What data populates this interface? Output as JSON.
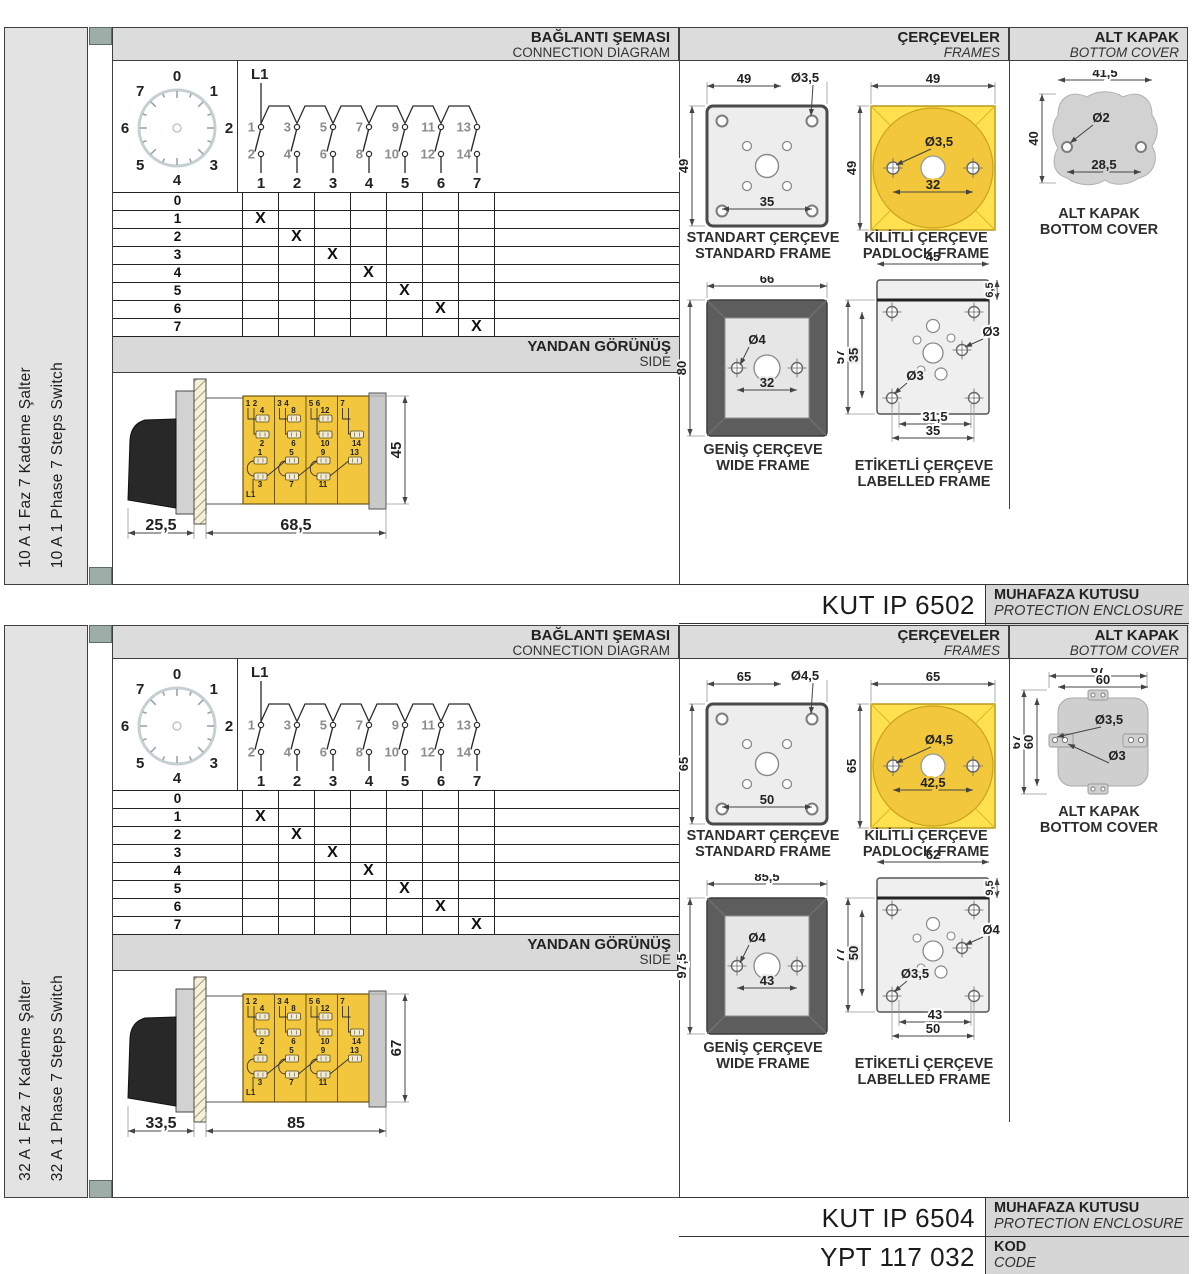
{
  "sections": [
    {
      "sidebar": {
        "tr": "10 A 1 Faz 7 Kademe Şalter",
        "en": "10 A 1 Phase 7 Steps Switch"
      },
      "header": {
        "diagram_tr": "BAĞLANTI ŞEMASI",
        "diagram_en": "CONNECTION DIAGRAM",
        "frames_tr": "ÇERÇEVELER",
        "frames_en": "FRAMES",
        "cover_tr": "ALT KAPAK",
        "cover_en": "BOTTOM COVER"
      },
      "side_band": {
        "tr": "YANDAN GÖRÜNÜŞ",
        "en": "SIDE"
      },
      "dial": {
        "positions": [
          "0",
          "1",
          "2",
          "3",
          "4",
          "5",
          "6",
          "7"
        ]
      },
      "circuit": {
        "feed": "L1",
        "top_contacts": [
          "1",
          "3",
          "5",
          "7",
          "9",
          "11",
          "13"
        ],
        "bottom_contacts": [
          "2",
          "4",
          "6",
          "8",
          "10",
          "12",
          "14"
        ],
        "switch_numbers": [
          "1",
          "2",
          "3",
          "4",
          "5",
          "6",
          "7"
        ]
      },
      "step_table": {
        "row_labels": [
          "0",
          "1",
          "2",
          "3",
          "4",
          "5",
          "6",
          "7"
        ],
        "mark": "X",
        "marks": [
          [
            1,
            1
          ],
          [
            2,
            2
          ],
          [
            3,
            3
          ],
          [
            4,
            4
          ],
          [
            5,
            5
          ],
          [
            6,
            6
          ],
          [
            7,
            7
          ]
        ]
      },
      "side_view": {
        "front_depth": "25,5",
        "body_length": "68,5",
        "height": "45",
        "feed": "L1",
        "top_pairs": [
          [
            "1",
            "2"
          ],
          [
            "3",
            "4"
          ],
          [
            "5",
            "6"
          ],
          [
            "7"
          ]
        ],
        "upper_mid": [
          "4",
          "8",
          "12",
          ""
        ],
        "lower_mid": [
          "2",
          "6",
          "10",
          "14"
        ],
        "bottom_upper": [
          "1",
          "5",
          "9",
          "13"
        ],
        "bottom_lower": [
          "3",
          "7",
          "11",
          ""
        ]
      },
      "frames": {
        "standard": {
          "caption_tr": "STANDART ÇERÇEVE",
          "caption_en": "STANDARD FRAME",
          "width": "49",
          "height": "49",
          "hole": "Ø3,5",
          "pitch": "35"
        },
        "padlock": {
          "caption_tr": "KİLİTLİ ÇERÇEVE",
          "caption_en": "PADLOCK FRAME",
          "width": "49",
          "height": "49",
          "hole": "Ø3,5",
          "pitch": "32"
        },
        "wide": {
          "caption_tr": "GENİŞ ÇERÇEVE",
          "caption_en": "WIDE FRAME",
          "width": "66",
          "height": "80",
          "hole": "Ø4",
          "pitch": "32"
        },
        "labelled": {
          "caption_tr": "ETİKETLİ ÇERÇEVE",
          "caption_en": "LABELLED FRAME",
          "width": "45",
          "band": "6,5",
          "height_outer": "57",
          "height_inner": "35",
          "hole_right": "Ø3",
          "hole_bottom": "Ø3",
          "pitch_inner": "31,5",
          "pitch_outer": "35"
        }
      },
      "cover": {
        "type": "round",
        "caption_tr": "ALT KAPAK",
        "caption_en": "BOTTOM COVER",
        "width": "41,5",
        "height": "40",
        "hole": "Ø2",
        "pitch": "28,5"
      },
      "codes": {
        "enclosure_code": "KUT IP 6502",
        "enclosure_tr": "MUHAFAZA KUTUSU",
        "enclosure_en": "PROTECTION ENCLOSURE",
        "order_code": "YPT 117 010",
        "code_tr": "KOD",
        "code_en": "CODE"
      }
    },
    {
      "sidebar": {
        "tr": "32 A 1 Faz 7 Kademe Şalter",
        "en": "32 A 1 Phase 7 Steps Switch"
      },
      "header": {
        "diagram_tr": "BAĞLANTI ŞEMASI",
        "diagram_en": "CONNECTION DIAGRAM",
        "frames_tr": "ÇERÇEVELER",
        "frames_en": "FRAMES",
        "cover_tr": "ALT KAPAK",
        "cover_en": "BOTTOM COVER"
      },
      "side_band": {
        "tr": "YANDAN GÖRÜNÜŞ",
        "en": "SIDE"
      },
      "dial": {
        "positions": [
          "0",
          "1",
          "2",
          "3",
          "4",
          "5",
          "6",
          "7"
        ]
      },
      "circuit": {
        "feed": "L1",
        "top_contacts": [
          "1",
          "3",
          "5",
          "7",
          "9",
          "11",
          "13"
        ],
        "bottom_contacts": [
          "2",
          "4",
          "6",
          "8",
          "10",
          "12",
          "14"
        ],
        "switch_numbers": [
          "1",
          "2",
          "3",
          "4",
          "5",
          "6",
          "7"
        ]
      },
      "step_table": {
        "row_labels": [
          "0",
          "1",
          "2",
          "3",
          "4",
          "5",
          "6",
          "7"
        ],
        "mark": "X",
        "marks": [
          [
            1,
            1
          ],
          [
            2,
            2
          ],
          [
            3,
            3
          ],
          [
            4,
            4
          ],
          [
            5,
            5
          ],
          [
            6,
            6
          ],
          [
            7,
            7
          ]
        ]
      },
      "side_view": {
        "front_depth": "33,5",
        "body_length": "85",
        "height": "67",
        "feed": "L1",
        "top_pairs": [
          [
            "1",
            "2"
          ],
          [
            "3",
            "4"
          ],
          [
            "5",
            "6"
          ],
          [
            "7"
          ]
        ],
        "upper_mid": [
          "4",
          "8",
          "12",
          ""
        ],
        "lower_mid": [
          "2",
          "6",
          "10",
          "14"
        ],
        "bottom_upper": [
          "1",
          "5",
          "9",
          "13"
        ],
        "bottom_lower": [
          "3",
          "7",
          "11",
          ""
        ]
      },
      "frames": {
        "standard": {
          "caption_tr": "STANDART ÇERÇEVE",
          "caption_en": "STANDARD FRAME",
          "width": "65",
          "height": "65",
          "hole": "Ø4,5",
          "pitch": "50"
        },
        "padlock": {
          "caption_tr": "KİLİTLİ ÇERÇEVE",
          "caption_en": "PADLOCK FRAME",
          "width": "65",
          "height": "65",
          "hole": "Ø4,5",
          "pitch": "42,5"
        },
        "wide": {
          "caption_tr": "GENİŞ ÇERÇEVE",
          "caption_en": "WIDE FRAME",
          "width": "85,5",
          "height": "97,5",
          "hole": "Ø4",
          "pitch": "43"
        },
        "labelled": {
          "caption_tr": "ETİKETLİ ÇERÇEVE",
          "caption_en": "LABELLED FRAME",
          "width": "62",
          "band": "9,5",
          "height_outer": "77",
          "height_inner": "50",
          "hole_right": "Ø4",
          "hole_bottom": "Ø3,5",
          "pitch_inner": "43",
          "pitch_outer": "50"
        }
      },
      "cover": {
        "type": "tabs",
        "caption_tr": "ALT KAPAK",
        "caption_en": "BOTTOM COVER",
        "outer_w": "67",
        "inner_w": "60",
        "outer_h": "67",
        "inner_h": "60",
        "hole_big": "Ø3,5",
        "hole_small": "Ø3"
      },
      "codes": {
        "enclosure_code": "KUT IP 6504",
        "enclosure_tr": "MUHAFAZA KUTUSU",
        "enclosure_en": "PROTECTION ENCLOSURE",
        "order_code": "YPT 117 032",
        "code_tr": "KOD",
        "code_en": "CODE"
      }
    }
  ]
}
